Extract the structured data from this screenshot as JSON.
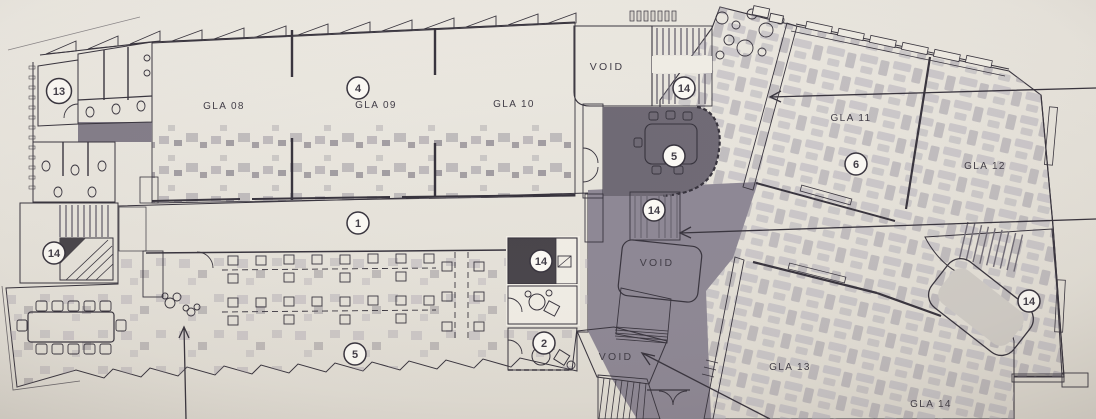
{
  "palette": {
    "paper": "#e9e5dd",
    "ink": "#3f3b45",
    "line": "#36323c",
    "glaDark": "#7a7481",
    "floor": "#8d8794",
    "wing": "#a7a3ae",
    "stair": "#474349",
    "stairStripe": "#6f6a75",
    "cream": "#f0ede5",
    "pink": "#c9a4a8",
    "lightRoom": "#d8d4cf",
    "badgeFill": "#fbf9f4",
    "room5": "#6e6974",
    "table": "#8e8994"
  },
  "labels": {
    "rooms": [
      {
        "id": "gla-08",
        "label": "GLA 08"
      },
      {
        "id": "gla-09",
        "label": "GLA 09"
      },
      {
        "id": "gla-10",
        "label": "GLA 10"
      },
      {
        "id": "gla-11",
        "label": "GLA 11"
      },
      {
        "id": "gla-12",
        "label": "GLA 12"
      },
      {
        "id": "gla-13",
        "label": "GLA 13"
      },
      {
        "id": "gla-14",
        "label": "GLA 14"
      }
    ],
    "voids": [
      "VOID",
      "VOID",
      "VOID"
    ],
    "badges": [
      {
        "n": "13"
      },
      {
        "n": "4"
      },
      {
        "n": "14"
      },
      {
        "n": "5"
      },
      {
        "n": "6"
      },
      {
        "n": "14"
      },
      {
        "n": "1"
      },
      {
        "n": "14"
      },
      {
        "n": "14"
      },
      {
        "n": "5"
      },
      {
        "n": "2"
      },
      {
        "n": "14"
      }
    ]
  }
}
